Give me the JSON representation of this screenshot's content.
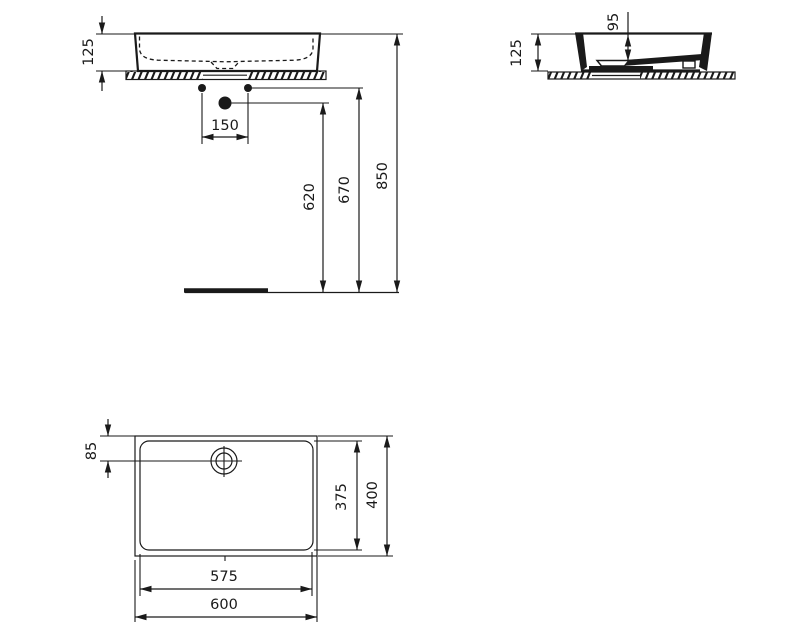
{
  "colors": {
    "line": "#1a1a1a",
    "background": "#ffffff"
  },
  "views": {
    "front": {
      "dims": {
        "height": "125",
        "tap_hole_spacing": "150",
        "outlet_height": "620",
        "supply_height": "670",
        "rim_height": "850"
      }
    },
    "side": {
      "dims": {
        "bowl_depth": "95",
        "height": "125"
      }
    },
    "top": {
      "dims": {
        "drain_offset": "85",
        "inner_depth": "375",
        "outer_depth": "400",
        "inner_width": "575",
        "outer_width": "600"
      }
    }
  }
}
